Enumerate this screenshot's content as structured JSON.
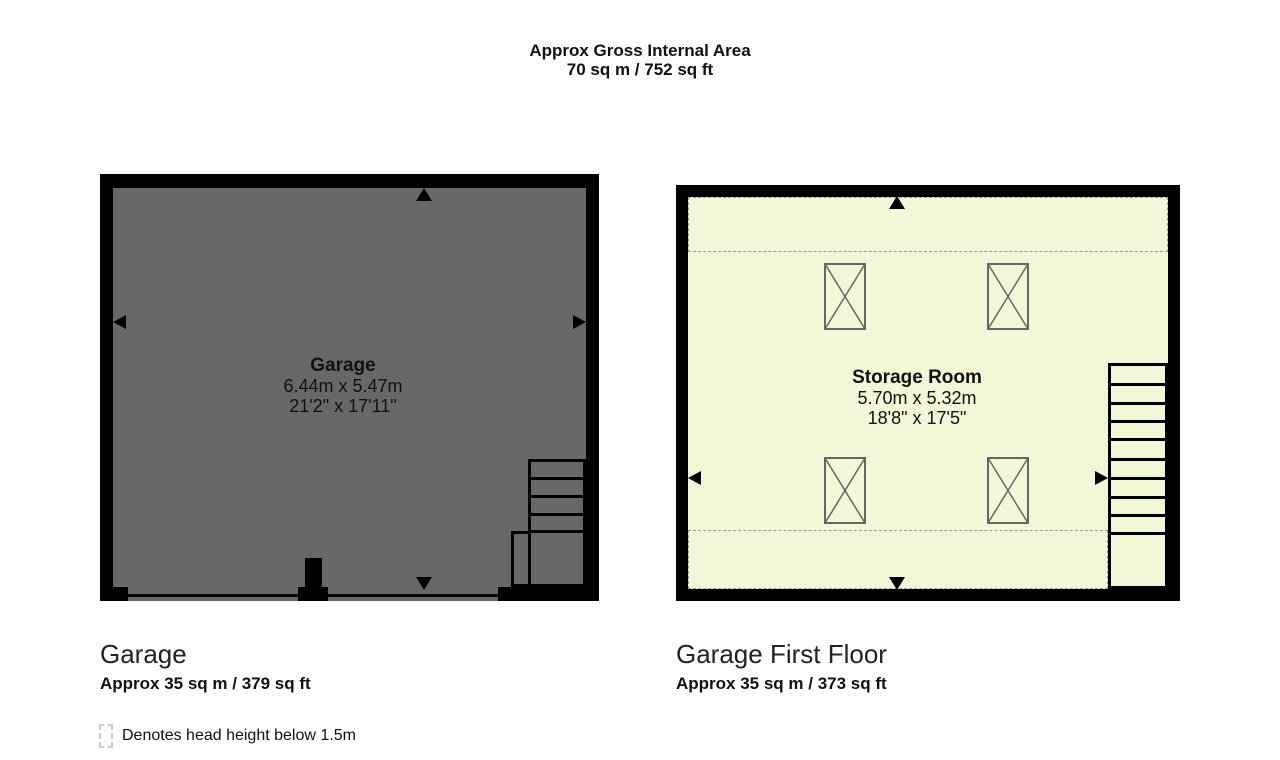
{
  "header": {
    "title": "Approx Gross Internal Area",
    "area": "70 sq m / 752 sq ft"
  },
  "ground_floor": {
    "room": {
      "name": "Garage",
      "size_metric": "6.44m x 5.47m",
      "size_imperial": "21'2\" x 17'11\""
    },
    "caption": {
      "title": "Garage",
      "area": "Approx 35 sq m / 379 sq ft"
    }
  },
  "first_floor": {
    "room": {
      "name": "Storage Room",
      "size_metric": "5.70m x 5.32m",
      "size_imperial": "18'8\" x 17'5\""
    },
    "caption": {
      "title": "Garage First Floor",
      "area": "Approx 35 sq m / 373 sq ft"
    }
  },
  "legend": {
    "label": "Denotes head height below 1.5m"
  },
  "colors": {
    "wall": "#000000",
    "ground_floor_fill": "#686868",
    "first_floor_fill": "#f4f6d8",
    "head_height_dash": "#999999",
    "truss_outline": "#666666",
    "legend_dash": "#cccccc"
  }
}
